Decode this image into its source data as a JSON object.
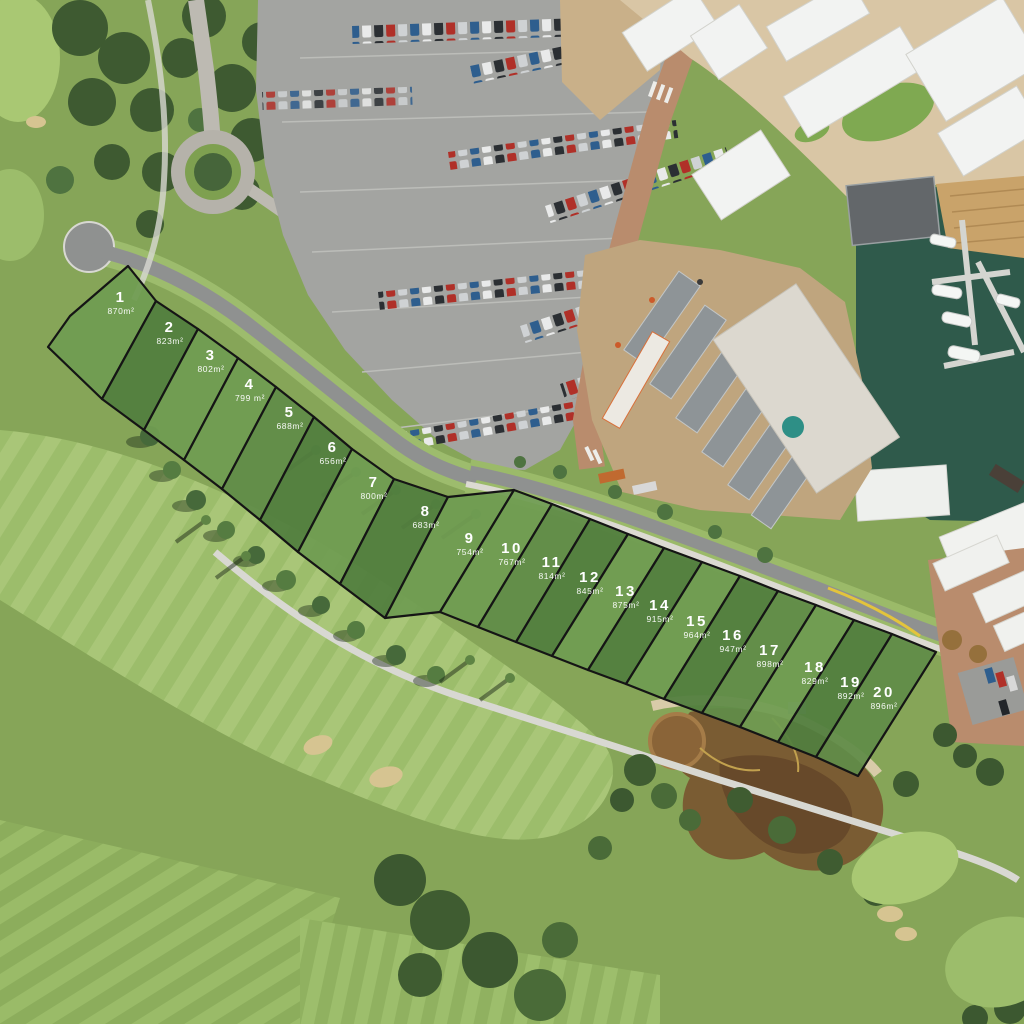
{
  "overlay": {
    "lot_count": 20
  },
  "palette": {
    "lot_fill_light": "#709C52",
    "lot_fill_mid": "#618C48",
    "lot_fill_dark": "#527E3F",
    "lot_outline": "#151515",
    "lot_label_text": "#FFFFFF",
    "grass": "#86A558",
    "fairway": "#9CBD6B",
    "trees_dark": "#3E5A31",
    "road_asphalt": "#8F9190",
    "parking_asphalt": "#A3A4A1",
    "brick_paving": "#B98C6D",
    "marina_water": "#2F5A4B",
    "boardwalk": "#C9A36A",
    "pond_water": "#7A5C33",
    "sand": "#D6C491",
    "building_roof_white": "#F2F3F2",
    "construction_dirt": "#BFA57E"
  },
  "lots": [
    {
      "number": "1",
      "area": "870m²",
      "tone": "light",
      "points": "70,316 128,266 156,301 102,399 48,347",
      "label": {
        "x": 121,
        "y": 302
      }
    },
    {
      "number": "2",
      "area": "823m²",
      "tone": "dark",
      "points": "156,301 198,329 144,430 102,399",
      "label": {
        "x": 170,
        "y": 332
      }
    },
    {
      "number": "3",
      "area": "802m²",
      "tone": "light",
      "points": "198,329 238,358 184,460 144,430",
      "label": {
        "x": 211,
        "y": 360
      }
    },
    {
      "number": "4",
      "area": "799 m²",
      "tone": "light",
      "points": "238,358 276,387 222,489 184,460",
      "label": {
        "x": 250,
        "y": 389
      }
    },
    {
      "number": "5",
      "area": "688m²",
      "tone": "mid",
      "points": "276,387 314,417 260,520 222,489",
      "label": {
        "x": 290,
        "y": 417
      }
    },
    {
      "number": "6",
      "area": "656m²",
      "tone": "dark",
      "points": "314,417 352,449 298,552 260,520",
      "label": {
        "x": 333,
        "y": 452
      }
    },
    {
      "number": "7",
      "area": "800m²",
      "tone": "light",
      "points": "352,449 394,479 340,584 298,552",
      "label": {
        "x": 374,
        "y": 487
      }
    },
    {
      "number": "8",
      "area": "683m²",
      "tone": "dark",
      "points": "394,479 448,497 385,618 340,584",
      "label": {
        "x": 426,
        "y": 516
      }
    },
    {
      "number": "9",
      "area": "754m²",
      "tone": "light",
      "points": "448,497 514,490 440,612 385,618",
      "label": {
        "x": 470,
        "y": 543
      }
    },
    {
      "number": "10",
      "area": "767m²",
      "tone": "light",
      "points": "514,490 552,504 478,627 440,612",
      "label": {
        "x": 512,
        "y": 553
      }
    },
    {
      "number": "11",
      "area": "814m²",
      "tone": "mid",
      "points": "552,504 590,519 516,642 478,627",
      "label": {
        "x": 552,
        "y": 567
      }
    },
    {
      "number": "12",
      "area": "845m²",
      "tone": "dark",
      "points": "590,519 628,534 552,656 516,642",
      "label": {
        "x": 590,
        "y": 582
      }
    },
    {
      "number": "13",
      "area": "875m²",
      "tone": "light",
      "points": "628,534 664,548 588,670 552,656",
      "label": {
        "x": 626,
        "y": 596
      }
    },
    {
      "number": "14",
      "area": "915m²",
      "tone": "dark",
      "points": "664,548 702,562 626,684 588,670",
      "label": {
        "x": 660,
        "y": 610
      }
    },
    {
      "number": "15",
      "area": "964m²",
      "tone": "light",
      "points": "702,562 740,576 664,699 626,684",
      "label": {
        "x": 697,
        "y": 626
      }
    },
    {
      "number": "16",
      "area": "947m²",
      "tone": "dark",
      "points": "740,576 778,591 702,713 664,699",
      "label": {
        "x": 733,
        "y": 640
      }
    },
    {
      "number": "17",
      "area": "898m²",
      "tone": "mid",
      "points": "778,591 816,605 740,727 702,713",
      "label": {
        "x": 770,
        "y": 655
      }
    },
    {
      "number": "18",
      "area": "829m²",
      "tone": "light",
      "points": "816,605 854,620 778,742 740,727",
      "label": {
        "x": 815,
        "y": 672
      }
    },
    {
      "number": "19",
      "area": "892m²",
      "tone": "dark",
      "points": "854,620 892,634 816,757 778,742",
      "label": {
        "x": 851,
        "y": 687
      }
    },
    {
      "number": "20",
      "area": "896m²",
      "tone": "mid",
      "points": "892,634 936,652 858,776 816,757",
      "label": {
        "x": 884,
        "y": 697
      }
    }
  ]
}
